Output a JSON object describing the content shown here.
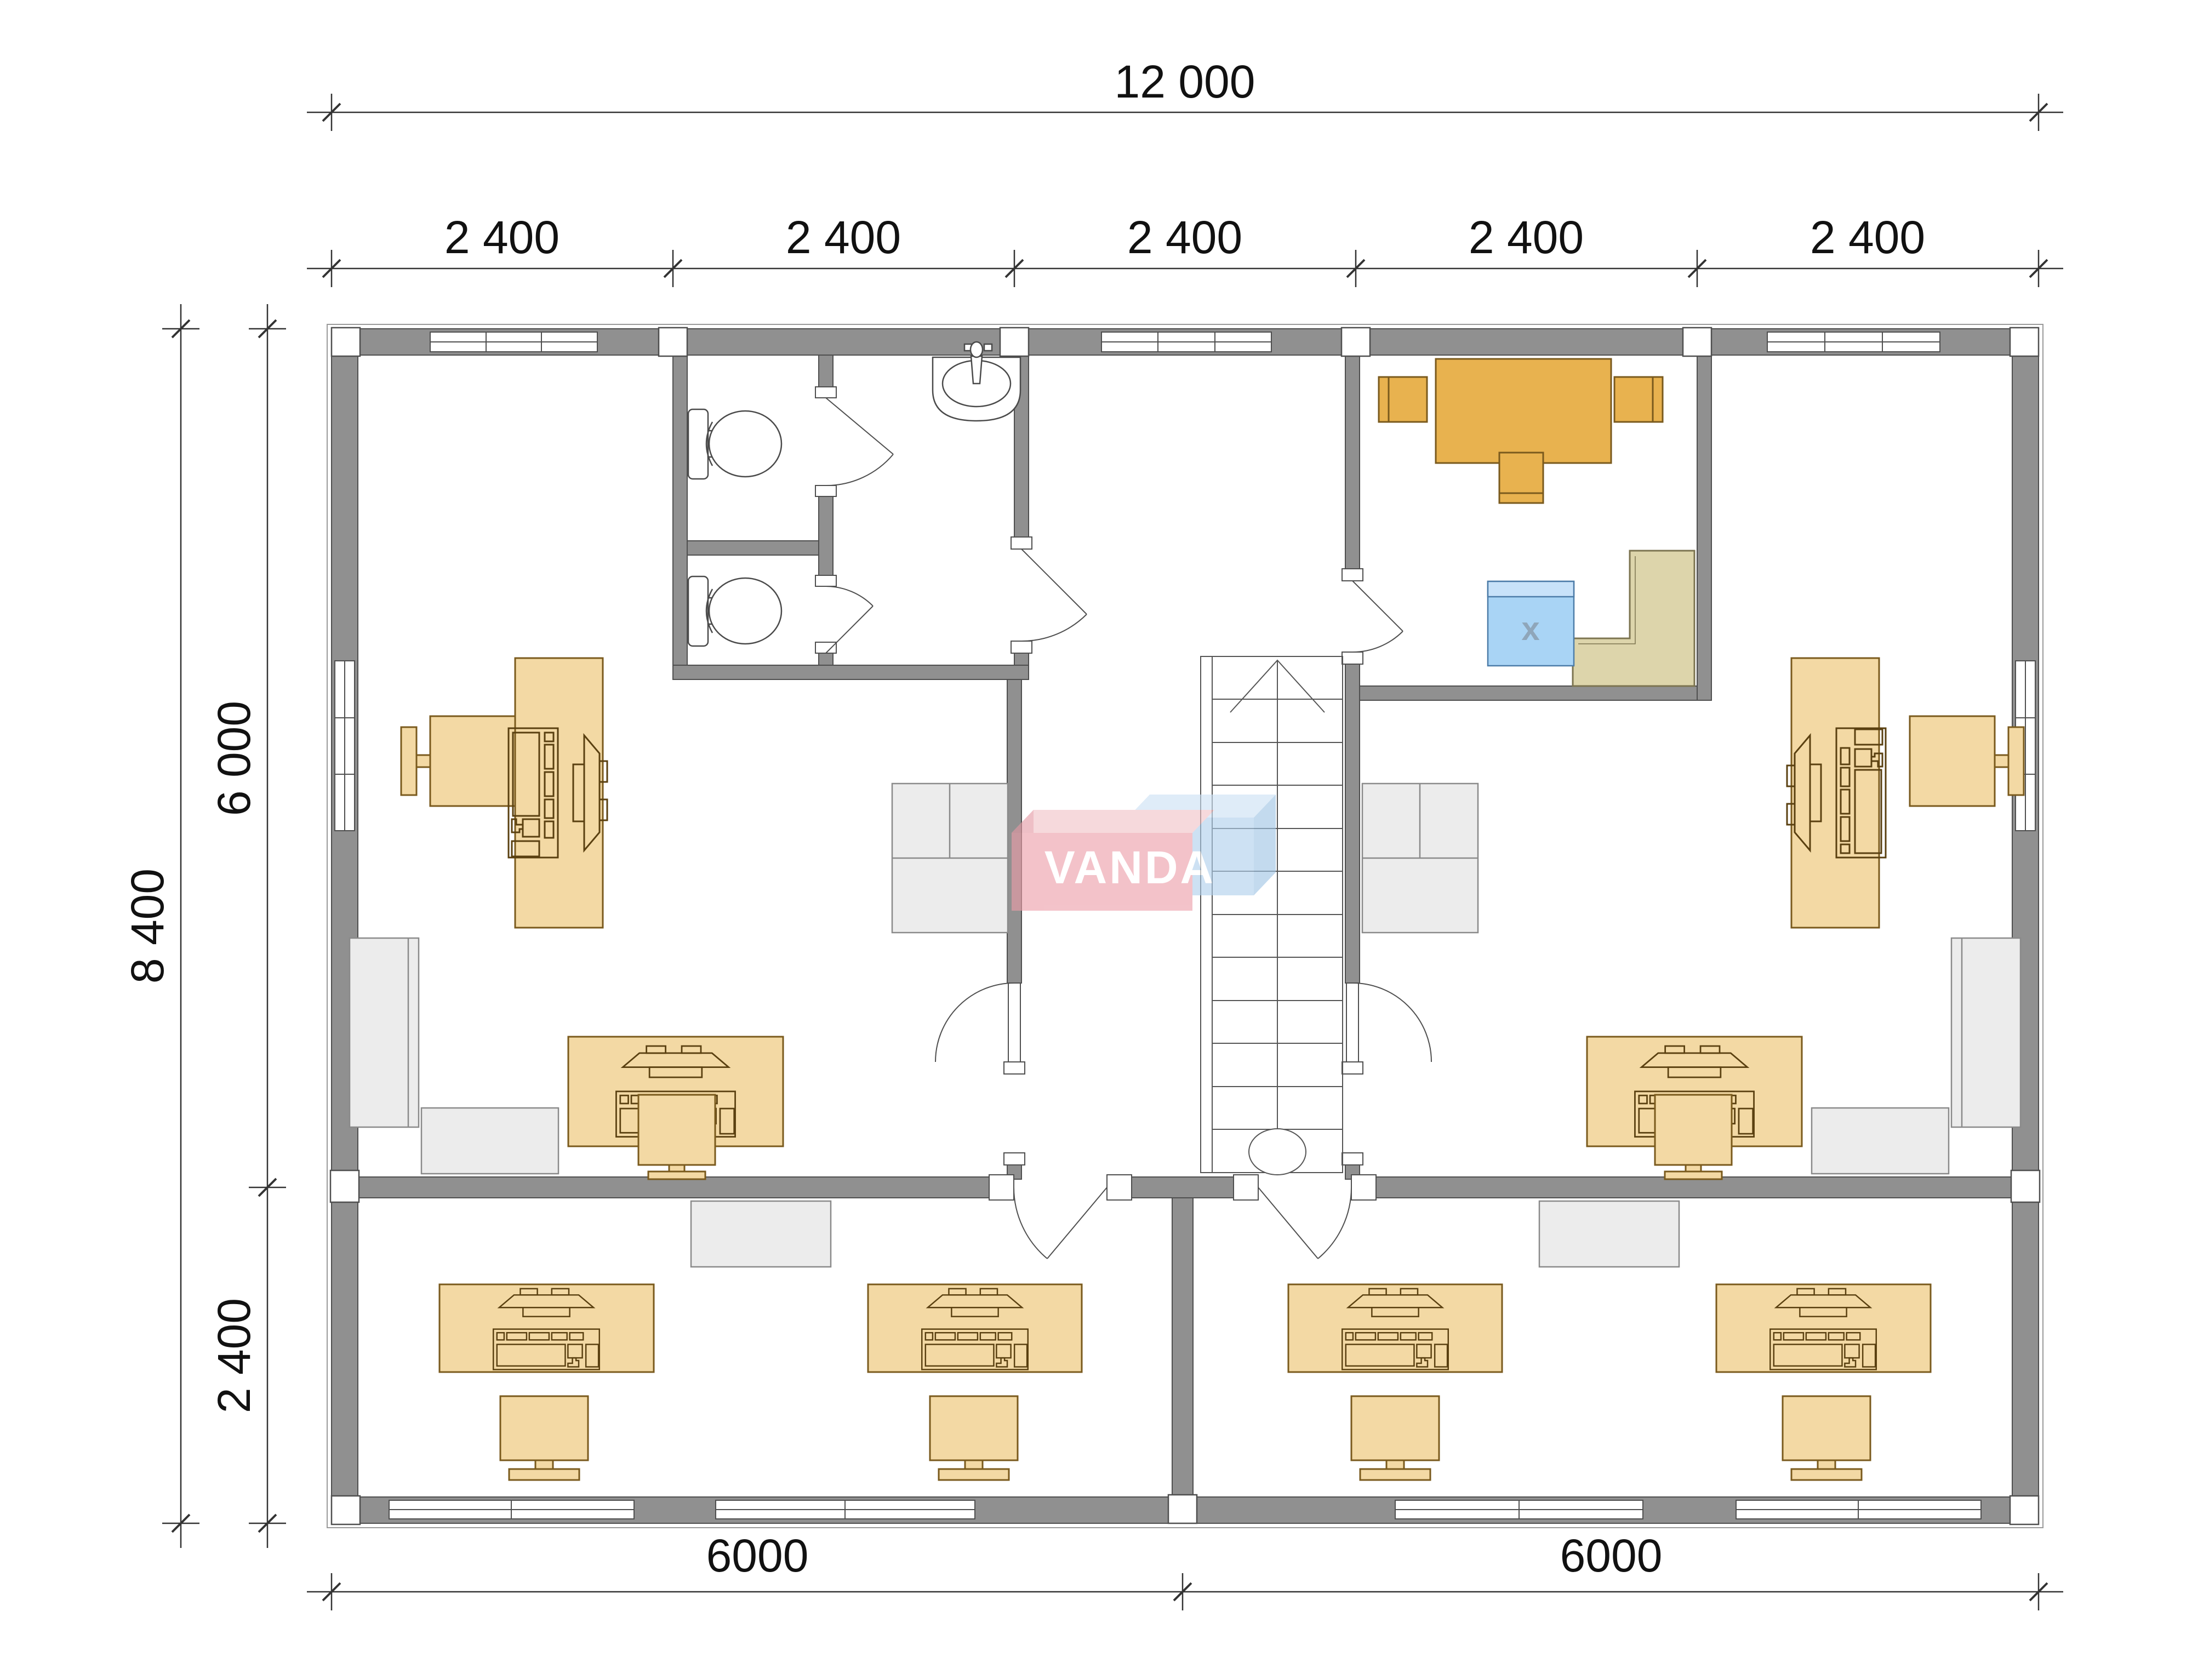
{
  "drawing_type": "architectural-floor-plan",
  "dimensions": {
    "overall_width": "12 000",
    "bay_widths": [
      "2 400",
      "2 400",
      "2 400",
      "2 400",
      "2 400"
    ],
    "overall_depth": "8 400",
    "upper_depth": "6 000",
    "lower_depth": "2 400",
    "bottom_left_width": "6000",
    "bottom_right_width": "6000"
  },
  "watermark": {
    "text": "VANDA",
    "red_box_color": "#ec9ea9",
    "blue_box_color": "#afcfec",
    "text_color": "#ffffff"
  },
  "labels": {
    "kitchen_appliance": "x"
  },
  "colors": {
    "wall_fill": "#909090",
    "wall_stroke": "#4f4f4f",
    "furniture_tan": "#f3d9a4",
    "furniture_outline": "#7a5a1d",
    "kitchen_amber": "#e8b24f",
    "cabinet_gray": "#ececec",
    "counter_khaki": "#ddd5ab",
    "appliance_blue": "#a9d4f5",
    "dim_text": "#111111"
  }
}
